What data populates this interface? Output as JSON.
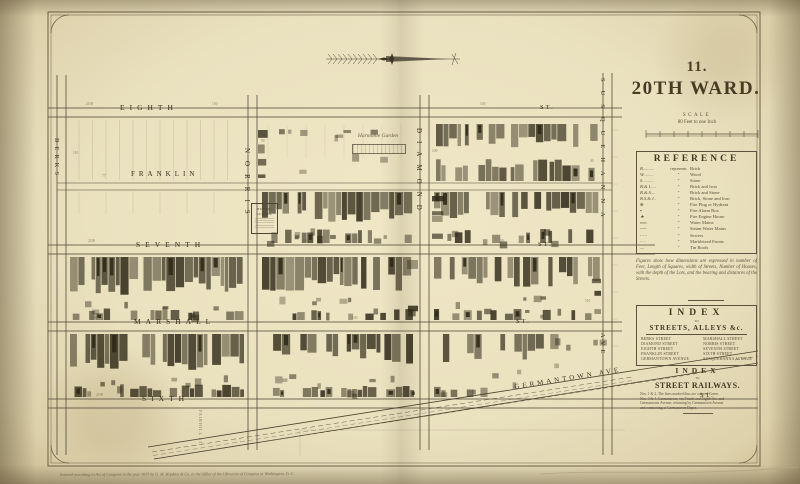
{
  "page": {
    "plate_number": "11.",
    "title": "20TH WARD.",
    "scale_word": "SCALE",
    "scale_sub": "80 Feet to one Inch",
    "copyright": "Entered according to Act of Congress in the year 1875 by G. M. Hopkins & Co. in the Office of the Librarian of Congress at Washington, D. C."
  },
  "reference": {
    "title": "REFERENCE",
    "first_row_word": "represents",
    "ditto": "”",
    "items": [
      {
        "symbol": "B..........",
        "label": "Brick"
      },
      {
        "symbol": "W.........",
        "label": "Wood"
      },
      {
        "symbol": "S..........",
        "label": "Stone"
      },
      {
        "symbol": "B.& I.....",
        "label": "Brick and Iron"
      },
      {
        "symbol": "B.& S....",
        "label": "Brick and Stone"
      },
      {
        "symbol": "B.S.& I..",
        "label": "Brick, Stone and Iron"
      },
      {
        "symbol": "⊕",
        "label": "Fire Plug or Hydrant"
      },
      {
        "symbol": "▪",
        "label": "Fire Alarm Box"
      },
      {
        "symbol": "★",
        "label": "Fire Engine House"
      },
      {
        "symbol": "══",
        "label": "Water Mains"
      },
      {
        "symbol": "──",
        "label": "Steam Water Mains"
      },
      {
        "symbol": "- - -",
        "label": "Sewers"
      },
      {
        "symbol": "·····",
        "label": "Marbleized Fronts"
      },
      {
        "symbol": "—",
        "label": "Tin Roofs"
      }
    ],
    "note": "Figures show how dimensions are expressed in number of Feet, Length of Squares, width of Streets, Number of Houses, with the depth of the Lots, and the bearing and distances of the Streets."
  },
  "street_index": {
    "title": "INDEX",
    "to_word": "TO",
    "subtitle": "STREETS, ALLEYS &c.",
    "left": [
      "BERKS STREET",
      "DIAMOND STREET",
      "EIGHTH STREET",
      "FRANKLIN STREET",
      "GERMANTOWN AVENUE"
    ],
    "right": [
      "MARSHALL STREET",
      "NORRIS STREET",
      "SEVENTH STREET",
      "SIXTH STREET",
      "SUSQUEHANNA AVENUE"
    ]
  },
  "railway_index": {
    "title": "INDEX",
    "to_word": "TO",
    "subtitle": "STREET RAILWAYS.",
    "lines": [
      "Nos. 1 & 2. The lines marked thus are colored Green.",
      "Nos. 3 & 4. Germantown, via Fourth and Eighth Sts. and",
      "Germantown Avenue; returning by Germantown Avenue",
      "and connecting at Germantown Depot."
    ]
  },
  "map": {
    "streets": {
      "eighth": "EIGHTH",
      "seventh": "SEVENTH",
      "marshall": "MARSHALL",
      "sixth": "SIXTH",
      "franklin": "FRANKLIN",
      "berks": "BERKS",
      "norris": "NORRIS",
      "diamond": "DIAMOND",
      "susquehanna": "SUSQUEHANNA",
      "ave": "AVE",
      "germantown_ave": "GERMANTOWN  AVE",
      "st_abbrev": "ST."
    },
    "labels": {
      "garden": "Harmonie Garden",
      "school_lines": [
        "PUBLIC",
        "SCHOOL"
      ],
      "side_street": "FAIRHILL ST."
    },
    "tiny_numbers": [
      {
        "t": "2100",
        "x": 86,
        "y": 103
      },
      {
        "t": "150",
        "x": 212,
        "y": 103
      },
      {
        "t": "100",
        "x": 480,
        "y": 103
      },
      {
        "t": "2100",
        "x": 88,
        "y": 240
      },
      {
        "t": "235",
        "x": 302,
        "y": 240
      },
      {
        "t": "50",
        "x": 500,
        "y": 240
      },
      {
        "t": "1100",
        "x": 90,
        "y": 317
      },
      {
        "t": "100",
        "x": 352,
        "y": 317
      },
      {
        "t": "2100",
        "x": 96,
        "y": 394
      },
      {
        "t": "80",
        "x": 402,
        "y": 394
      },
      {
        "t": "77",
        "x": 102,
        "y": 175
      },
      {
        "t": "50",
        "x": 261,
        "y": 140
      },
      {
        "t": "100",
        "x": 432,
        "y": 150
      },
      {
        "t": "40",
        "x": 590,
        "y": 160
      },
      {
        "t": "110",
        "x": 73,
        "y": 152
      },
      {
        "t": "110",
        "x": 585,
        "y": 300
      }
    ]
  }
}
